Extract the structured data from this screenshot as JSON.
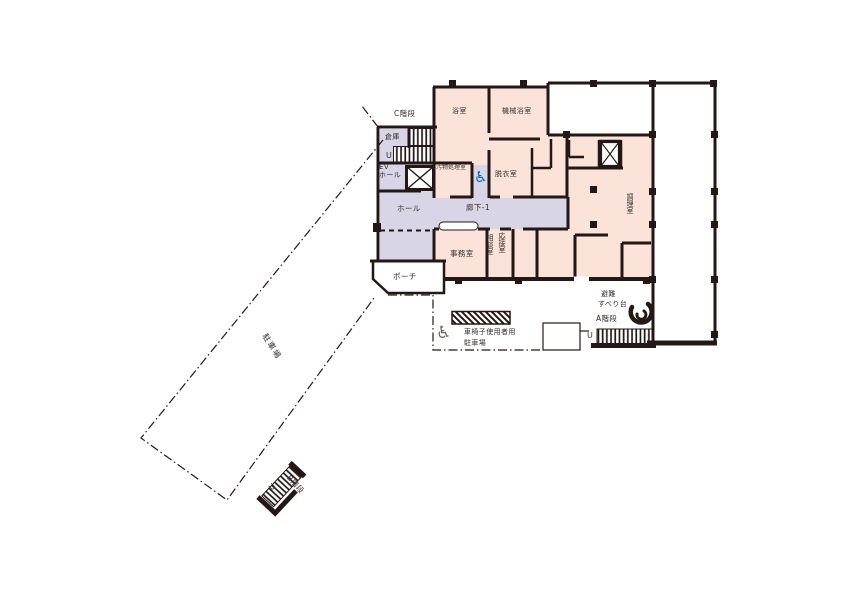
{
  "document": {
    "type": "floor-plan",
    "language": "ja"
  },
  "colors": {
    "background": "#ffffff",
    "room_pink": "#fbe3d9",
    "corridor_lavender": "#d8d5e7",
    "wall_black": "#231815",
    "accessible_blue": "#0068b7",
    "label_text": "#332d2a"
  },
  "labels": {
    "c_stairs": "C階段",
    "storage": "倉庫",
    "up_mark": "U",
    "ev_line1": "EV",
    "ev_line2": "ホール",
    "bath": "浴室",
    "machine_bath": "機械浴室",
    "waste_room": "汚物処理室",
    "dressing": "脱衣室",
    "hall": "ホール",
    "corridor": "廊下-1",
    "office": "事務室",
    "consult": "相談室",
    "reception": "応接室",
    "kitchen": "調理室",
    "porch": "ポーチ",
    "parking_lot": "駐車場",
    "wc_parking_line1": "車椅子使用者用",
    "wc_parking_line2": "駐車場",
    "evac_slide_line1": "避難",
    "evac_slide_line2": "すべり台",
    "a_stairs": "A階段",
    "b_stairs": "B階段"
  },
  "icons": {
    "wheelchair": "♿"
  }
}
